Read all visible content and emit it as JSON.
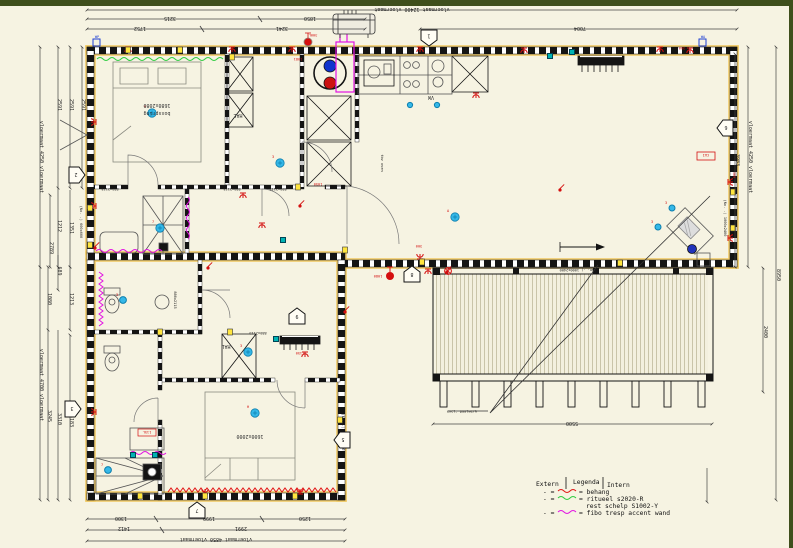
{
  "colors": {
    "background": "#f6f3e2",
    "frame_green": "#3f4f1c",
    "wall_yellow": "#f0c75e",
    "wall_black": "#141414",
    "symbol_red": "#d40f0f",
    "light_blue": "#35b8e8",
    "accent_magenta": "#e212e2",
    "accent_green": "#2ecc40",
    "accent_cyan": "#00b3b3",
    "deck_plank": "#c9c4a8"
  },
  "dims": {
    "top_total": "vloermaat 12400 vloermaat",
    "t3215": "3215",
    "t1850": "1850",
    "t1752": "1752",
    "t3241": "3241",
    "t7004": "7004",
    "lu_total": "vloermaat 4250 vloermaat",
    "l2591a": "2591",
    "l2591b": "2591",
    "l2591c": "2591",
    "l1212": "1212",
    "l1351": "1351",
    "l2789": "2789",
    "win600": "(No. .) 600x600",
    "ll_total": "vloermaat 4700 vloermaat",
    "l689": "689",
    "l1080": "1080",
    "l1213": "1213",
    "l3245": "3245",
    "l3310": "3310",
    "l3183": "3183",
    "b1300": "1300",
    "b1999": "1999",
    "b1250": "1250",
    "b1412": "1412",
    "b2991": "2991",
    "b_total": "vloermaat 4850 vloermaat",
    "r3983": "3983",
    "ru_total": "vloermaat 4250 vloermaat",
    "r2400": "2400",
    "r8950": "8950",
    "d5500": "5500"
  },
  "labels": {
    "bed1_size": "1680x2080",
    "bed1_name": "boxspring",
    "bed2_size": "1600x2000",
    "hal1": "HAL",
    "hal2": "HAL",
    "vw": "VW",
    "oven": "tbv oven",
    "wa": "WA",
    "wp": "WP",
    "w880": "880x2115",
    "w1000": "(No. .) 1000x2400",
    "deck_note": "excl. paalwerk"
  },
  "tags": {
    "s300": "300",
    "s1050": "1050",
    "s1081": "1081",
    "s300l": "300L",
    "s115l": "115L",
    "cai": "CAI",
    "s1150": "1150",
    "s1080": "1080"
  },
  "lights": {
    "a": "A",
    "h": "H",
    "n3": "3",
    "n7": "7",
    "n9": "9",
    "n8": "8"
  },
  "markers": {
    "m1": "1",
    "m2": "2",
    "m3": "3",
    "m5": "5",
    "m6": "6",
    "m7": "7",
    "m8": "8",
    "m9": "9"
  },
  "legend": {
    "extern": "Extern",
    "title": "Legenda",
    "intern": "Intern",
    "prefix": "- =",
    "item1": "= behang",
    "item2": "= ritueel s2020-R",
    "item2b": "rest schelp S1002-Y",
    "item3": "= fibo tresp accent wand"
  }
}
